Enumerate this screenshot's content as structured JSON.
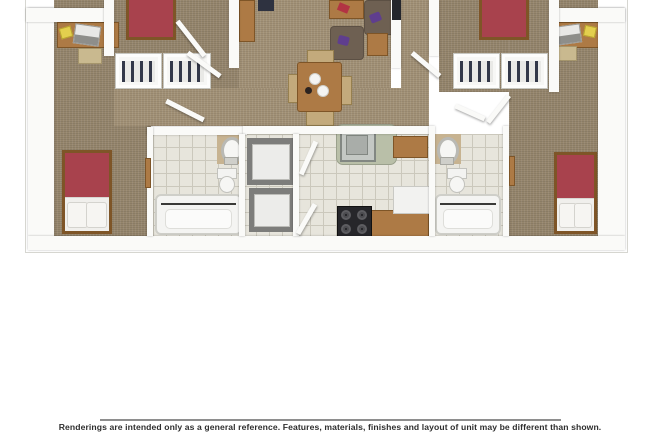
{
  "disclaimer": {
    "text": "Renderings are intended only as a general reference. Features, materials, finishes and layout of unit may be different than shown."
  },
  "colors": {
    "page-bg": "#ffffff",
    "card-edge": "#d6d6d1",
    "carpet": "#96866d",
    "carpet-light": "#a29176",
    "wall": "#fafaf8",
    "tile": "#e7e5dc",
    "tile-line": "#cbc8bc",
    "bed-red": "#a8424d",
    "sheet": "#f0efec",
    "wood": "#ad7a45",
    "wood-dark": "#7e5527",
    "clothes": "#333849",
    "sofa": "#6e6052",
    "pillow-purple": "#5f3e8e",
    "counter-sage": "#b9bfa8",
    "stove-black": "#26262a",
    "tan-wall": "#c7b391",
    "divider": "#8e8e8e",
    "text": "#2e2e2e"
  }
}
